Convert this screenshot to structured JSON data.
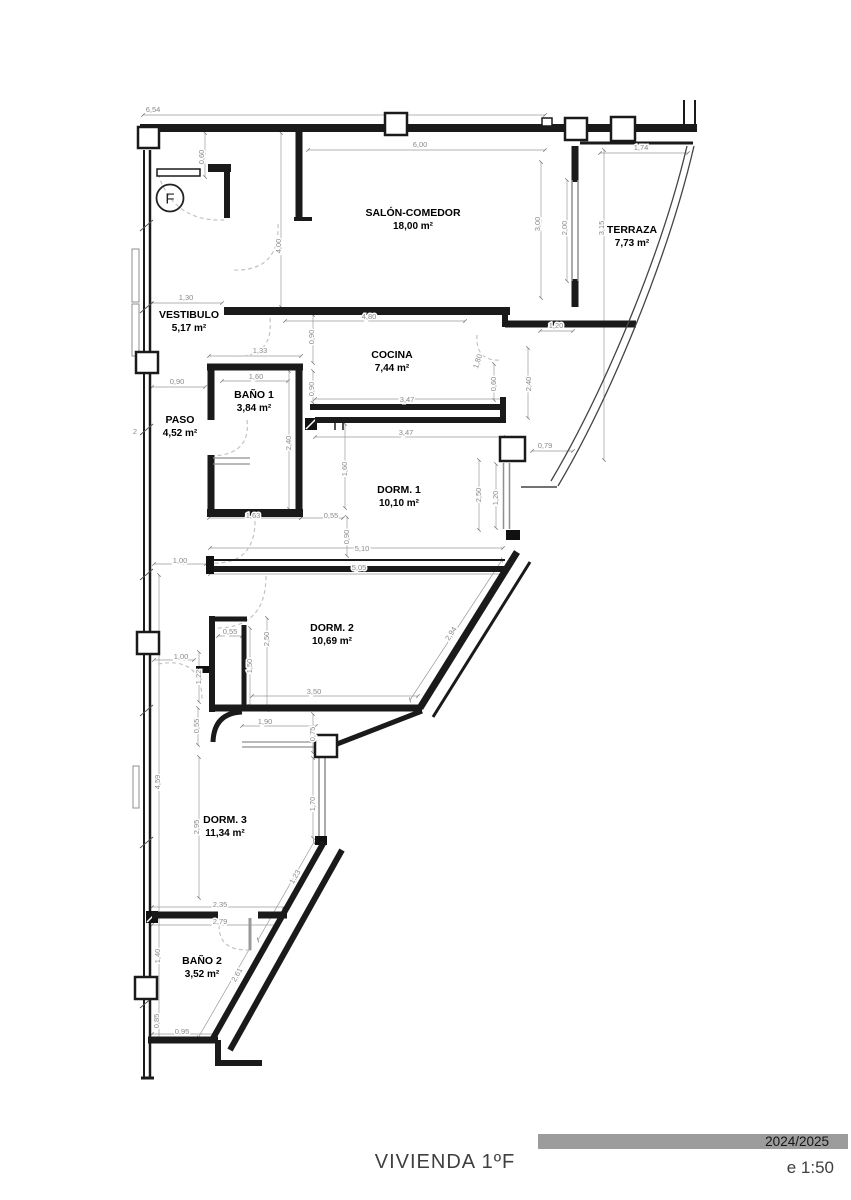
{
  "flat_circle": {
    "label": "F"
  },
  "title_block": {
    "title": "VIVIENDA 1ºF",
    "period": "2024/2025",
    "scale": "e 1:50"
  },
  "colors": {
    "wall": "#1a1a1a",
    "dimension": "#8a8a8a",
    "title_bar": "#9c9c9c",
    "door_arc": "#c3c3c3"
  },
  "rooms": [
    {
      "name": "SALÓN-COMEDOR",
      "area": "18,00 m²",
      "x": 413,
      "y": 216
    },
    {
      "name": "TERRAZA",
      "area": "7,73 m²",
      "x": 632,
      "y": 233
    },
    {
      "name": "VESTIBULO",
      "area": "5,17 m²",
      "x": 189,
      "y": 318
    },
    {
      "name": "COCINA",
      "area": "7,44 m²",
      "x": 392,
      "y": 358
    },
    {
      "name": "BAÑO 1",
      "area": "3,84 m²",
      "x": 254,
      "y": 398
    },
    {
      "name": "PASO",
      "area": "4,52 m²",
      "x": 180,
      "y": 423
    },
    {
      "name": "DORM. 1",
      "area": "10,10 m²",
      "x": 399,
      "y": 493
    },
    {
      "name": "DORM. 2",
      "area": "10,69 m²",
      "x": 332,
      "y": 631
    },
    {
      "name": "DORM. 3",
      "area": "11,34 m²",
      "x": 225,
      "y": 823
    },
    {
      "name": "BAÑO 2",
      "area": "3,52 m²",
      "x": 202,
      "y": 964
    }
  ],
  "dimensions": [
    {
      "v": "6,54",
      "x": 153,
      "y": 112,
      "r": 0
    },
    {
      "v": "0,60",
      "x": 204,
      "y": 157,
      "r": -90
    },
    {
      "v": "6,00",
      "x": 420,
      "y": 147,
      "r": 0
    },
    {
      "v": "1,74",
      "x": 641,
      "y": 150,
      "r": 0
    },
    {
      "v": "3,00",
      "x": 540,
      "y": 224,
      "r": -90
    },
    {
      "v": "2,00",
      "x": 567,
      "y": 228,
      "r": -90
    },
    {
      "v": "3,15",
      "x": 604,
      "y": 228,
      "r": -90
    },
    {
      "v": "4,00",
      "x": 281,
      "y": 246,
      "r": -90
    },
    {
      "v": "1,30",
      "x": 186,
      "y": 300,
      "r": 0
    },
    {
      "v": "4,80",
      "x": 369,
      "y": 319,
      "r": 0
    },
    {
      "v": "1,20",
      "x": 556,
      "y": 328,
      "r": 0
    },
    {
      "v": "0,90",
      "x": 314,
      "y": 337,
      "r": -90
    },
    {
      "v": "1,33",
      "x": 260,
      "y": 353,
      "r": 0
    },
    {
      "v": "1,60",
      "x": 256,
      "y": 379,
      "r": 0
    },
    {
      "v": "0,90",
      "x": 314,
      "y": 389,
      "r": -90
    },
    {
      "v": "0,90",
      "x": 177,
      "y": 384,
      "r": 0
    },
    {
      "v": "1,80",
      "x": 480,
      "y": 362,
      "r": -72
    },
    {
      "v": "0,60",
      "x": 496,
      "y": 384,
      "r": -90
    },
    {
      "v": "2,40",
      "x": 531,
      "y": 384,
      "r": -90
    },
    {
      "v": "3,47",
      "x": 407,
      "y": 402,
      "r": 0
    },
    {
      "v": "3,47",
      "x": 406,
      "y": 435,
      "r": 0
    },
    {
      "v": "2,40",
      "x": 291,
      "y": 443,
      "r": -90
    },
    {
      "v": "1,60",
      "x": 347,
      "y": 469,
      "r": -90
    },
    {
      "v": "0,79",
      "x": 545,
      "y": 448,
      "r": 0
    },
    {
      "v": "2,50",
      "x": 481,
      "y": 495,
      "r": -90
    },
    {
      "v": "1,20",
      "x": 498,
      "y": 498,
      "r": -90
    },
    {
      "v": "1,63",
      "x": 253,
      "y": 518,
      "r": 0
    },
    {
      "v": "0,55",
      "x": 331,
      "y": 518,
      "r": 0
    },
    {
      "v": "0,90",
      "x": 349,
      "y": 537,
      "r": -90
    },
    {
      "v": "5,10",
      "x": 362,
      "y": 551,
      "r": 0
    },
    {
      "v": "5,05",
      "x": 359,
      "y": 570,
      "r": 0
    },
    {
      "v": "1,00",
      "x": 180,
      "y": 563,
      "r": 0
    },
    {
      "v": "0,55",
      "x": 230,
      "y": 634,
      "r": 0
    },
    {
      "v": "2,50",
      "x": 269,
      "y": 639,
      "r": -90
    },
    {
      "v": "1,50",
      "x": 252,
      "y": 666,
      "r": -90
    },
    {
      "v": "2,94",
      "x": 453,
      "y": 635,
      "r": -57
    },
    {
      "v": "1,00",
      "x": 181,
      "y": 659,
      "r": 0
    },
    {
      "v": "1,22",
      "x": 201,
      "y": 677,
      "r": -90
    },
    {
      "v": "3,50",
      "x": 314,
      "y": 694,
      "r": 0
    },
    {
      "v": "1,90",
      "x": 265,
      "y": 724,
      "r": 0
    },
    {
      "v": "0,55",
      "x": 199,
      "y": 726,
      "r": -90
    },
    {
      "v": "0,75",
      "x": 315,
      "y": 734,
      "r": -90
    },
    {
      "v": "4,59",
      "x": 160,
      "y": 782,
      "r": -90
    },
    {
      "v": "1,70",
      "x": 315,
      "y": 804,
      "r": -90
    },
    {
      "v": "2,95",
      "x": 199,
      "y": 827,
      "r": -90
    },
    {
      "v": "1,23",
      "x": 297,
      "y": 878,
      "r": -60
    },
    {
      "v": "2,35",
      "x": 220,
      "y": 907,
      "r": 0
    },
    {
      "v": "2,79",
      "x": 220,
      "y": 924,
      "r": 0
    },
    {
      "v": "1,40",
      "x": 160,
      "y": 956,
      "r": -90
    },
    {
      "v": "2,61",
      "x": 239,
      "y": 976,
      "r": -60
    },
    {
      "v": "0,85",
      "x": 159,
      "y": 1021,
      "r": -90
    },
    {
      "v": "0,95",
      "x": 182,
      "y": 1034,
      "r": 0
    },
    {
      "v": "2",
      "x": 135,
      "y": 434,
      "r": 0
    }
  ]
}
